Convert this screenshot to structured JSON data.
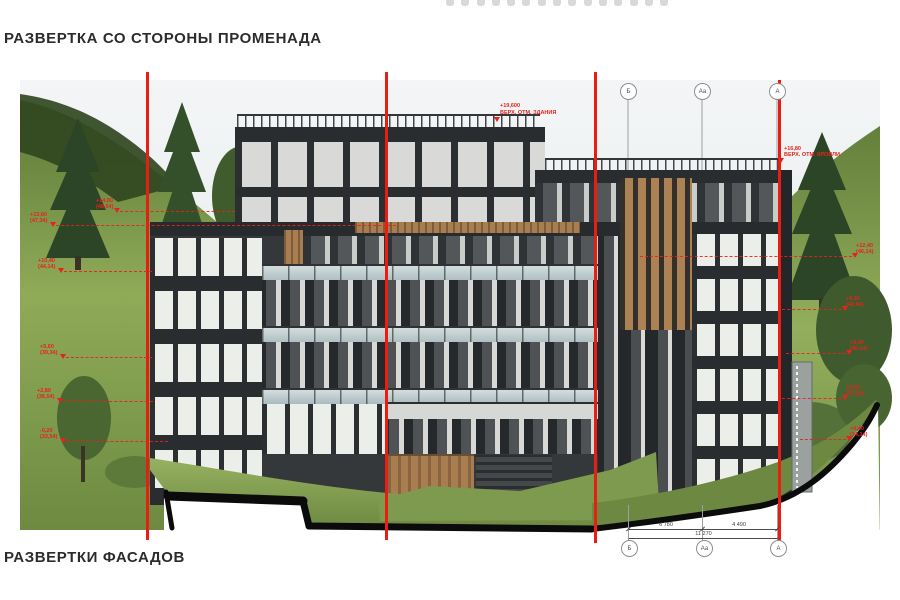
{
  "titles": {
    "top": "РАЗВЕРТКА СО СТОРОНЫ ПРОМЕНАДА",
    "bottom": "РАЗВЕРТКИ ФАСАДОВ"
  },
  "axes": {
    "bubbles": [
      "Б",
      "Аа",
      "А"
    ]
  },
  "dimensions": {
    "seg1": "6 780",
    "seg2": "4 490",
    "total": "11 270"
  },
  "roof_note": {
    "l1": "+19,600",
    "l2": "ВЕРХ. ОТМ. ЗДАНИЯ"
  },
  "levels": {
    "left": [
      {
        "l1": "+14,80",
        "l2": "(48,54)"
      },
      {
        "l1": "+13,60",
        "l2": "(47,34)"
      },
      {
        "l1": "+10,40",
        "l2": "(44,14)"
      },
      {
        "l1": "+5,60",
        "l2": "(39,34)"
      },
      {
        "l1": "+2,80",
        "l2": "(36,54)"
      },
      {
        "l1": "-0,20",
        "l2": "(33,54)"
      }
    ],
    "right": [
      {
        "l1": "+16,80",
        "l2": "ВЕРХ. ОТМ. КРОВЛИ"
      },
      {
        "l1": "+12,40",
        "l2": "(46,14)"
      },
      {
        "l1": "+9,20",
        "l2": "(42,94)"
      },
      {
        "l1": "+6,40",
        "l2": "(40,14)"
      },
      {
        "l1": "+3,60",
        "l2": "(37,34)"
      },
      {
        "l1": "+0,40",
        "l2": "(34,14)"
      }
    ]
  },
  "colors": {
    "accent_red": "#e8231b",
    "facade_dark": "#34373a",
    "wood": "#a87e51",
    "glass": "#b7c6ca",
    "grass": "#86a350",
    "forest": "#31471f",
    "sky": "#ecf0f2"
  }
}
